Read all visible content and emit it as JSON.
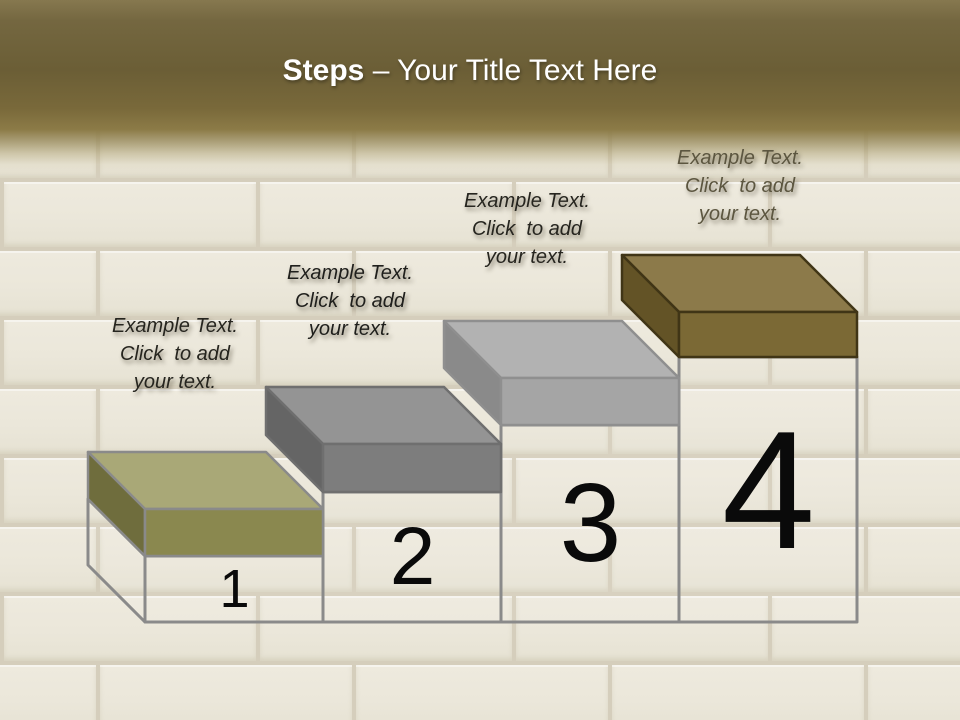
{
  "slide": {
    "title": {
      "emphasis": "Steps",
      "rest": " – Your Title Text Here",
      "color": "#ffffff"
    },
    "header": {
      "gradient_top": "#86784f",
      "gradient_mid": "#6b5e36",
      "gradient_gold": "#8c7b47"
    },
    "background": {
      "brick": "#ebe7da",
      "mortar": "#d5cebc"
    }
  },
  "numbers_color": "#0a0a0a",
  "steps": [
    {
      "number": "1",
      "label": "Example Text.\nClick  to add\nyour text.",
      "label_color": "#26251f",
      "colors": {
        "top": "#a9a877",
        "front": "#8a884f",
        "side": "#6f6d3d",
        "outline": "#8a8a8a",
        "body_outline": "#8a8a8a"
      }
    },
    {
      "number": "2",
      "label": "Example Text.\nClick  to add\nyour text.",
      "label_color": "#1f1f1c",
      "colors": {
        "top": "#949494",
        "front": "#7d7d7d",
        "side": "#656565",
        "outline": "#6f6f6f",
        "body_outline": "#8a8a8a"
      }
    },
    {
      "number": "3",
      "label": "Example Text.\nClick  to add\nyour text.",
      "label_color": "#26251f",
      "colors": {
        "top": "#b2b2b2",
        "front": "#a5a5a5",
        "side": "#8a8a8a",
        "outline": "#8f8f8f",
        "body_outline": "#8a8a8a"
      }
    },
    {
      "number": "4",
      "label": "Example Text.\nClick  to add\nyour text.",
      "label_color": "#5c5640",
      "colors": {
        "top": "#8c7a4a",
        "front": "#7b6935",
        "side": "#635326",
        "outline": "#403516",
        "body_outline": "#8a8a8a"
      }
    }
  ]
}
